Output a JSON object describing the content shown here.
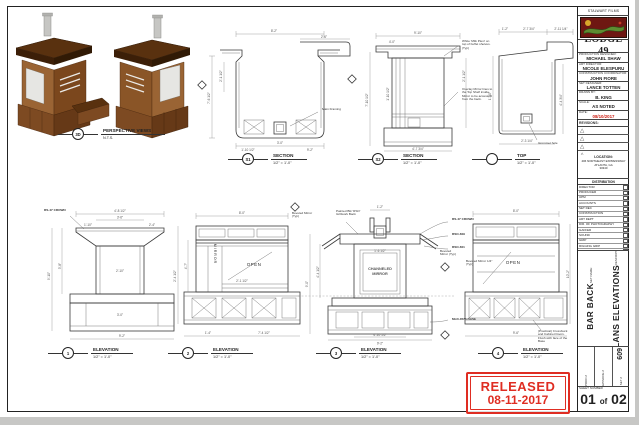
{
  "titleblock": {
    "studio": "STALWART FILMS",
    "show": "LODGE 49",
    "credits": [
      {
        "label": "PRODUCTION DESIGNER:",
        "value": "MICHAEL SHAW"
      },
      {
        "label": "ART DIRECTOR:",
        "value": "NICOLE ELESPURU"
      },
      {
        "label": "CONSTRUCTION COORDINATOR:",
        "value": "JOHN FIORE"
      },
      {
        "label": "SET DESIGNER:",
        "value": "LANCE TOTTEN"
      },
      {
        "label": "DRAWN BY:",
        "value": "B. KING"
      },
      {
        "label": "SCALE:",
        "value": "AS NOTED"
      },
      {
        "label": "DATE:",
        "value": "08/10/2017"
      }
    ],
    "revisions_label": "REVISIONS:",
    "location_label": "LOCATION:",
    "location_lines": [
      "406 NORTHEAST EXPRESSWAY",
      "ATLANTA, GA",
      "30340"
    ],
    "distribution_label": "DISTRIBUTION",
    "distribution": [
      "DIRECTOR",
      "PRODUCER",
      "UPM",
      "ACCOUNTS",
      "SET DEC",
      "CONSTRUCTION",
      "ART DEPT",
      "DIR. OF PHOTOGRAPHY",
      "GAFFER",
      "SOUND",
      "GRIP",
      "RIGGING GRIP",
      "SP. FX",
      "FILE",
      "LOCATIONS"
    ],
    "set_name_label": "SET NAME:",
    "set_name": "BAR BACK",
    "description_label": "DESCRIPTION:",
    "description": "PLANS ELEVATIONS",
    "prod_label": "PROD #",
    "episode_label": "EPISODE #",
    "set_no_label": "SET #",
    "set_no": "609",
    "sheet_number_label": "SHEET NUMBER",
    "sheet_number_left": "01",
    "sheet_number_of": "of",
    "sheet_number_right": "02"
  },
  "stamp": {
    "line1": "RELEASED",
    "line2": "08-11-2017"
  },
  "views": {
    "perspective": {
      "tag": "3D",
      "title": "PERSPECTIVE VIEWS",
      "scale": "N.T.S."
    },
    "section1": {
      "tag": "S1",
      "title": "SECTION",
      "scale": "1/2\" = 1'-0\"",
      "note": "Main Framing",
      "dims": [
        "8'-2\"",
        "2'-6\"",
        "2'-1 1/2\"",
        "7'-6 1/2\"",
        "3'-0\"",
        "1'-10 1/2\"",
        "9'-2\""
      ]
    },
    "section2": {
      "tag": "S2",
      "title": "SECTION",
      "scale": "1/2\" = 1'-0\"",
      "note1": "White 'Milk Plexi' on top of buffet shelves. (Typ)",
      "note2": "Overlay Mirror lines to the Top Shelf inside. Mirror to be accessed from the back.",
      "dims": [
        "9'-10\"",
        "4'-0\"",
        "2'-1 1/2\"",
        "7'-10 1/2\"",
        "1'-10 1/2\"",
        "4'-7 3/4\""
      ]
    },
    "top": {
      "tag": "",
      "title": "TOP",
      "scale": "1/2\" = 1'-0\"",
      "note": "Grommet hole",
      "dims": [
        "1'-2\"",
        "2'-7 3/4\"",
        "2'-11 1/4\"",
        "1'-10\"",
        "4'-4 3/4\"",
        "2'-3 1/4\""
      ]
    },
    "elev1": {
      "tag": "1",
      "title": "ELEVATION",
      "scale": "1/2\" = 1'-0\"",
      "callout": "RS-47 CROWN",
      "dims": [
        "4'-8 1/2\"",
        "3'-6\"",
        "1'-10\"",
        "2'-4\"",
        "9'-10\"",
        "3'-8\"",
        "2'-10\"",
        "3'-0\"",
        "9'-2\""
      ]
    },
    "elev2": {
      "tag": "2",
      "title": "ELEVATION",
      "scale": "1/2\" = 1'-0\"",
      "mirror_label": "MIRROR",
      "open_label": "OPEN",
      "note": "Beveled Mirror (Typ)",
      "dims": [
        "8'-0\"",
        "2'-4 1/2\"",
        "4'-7\"",
        "2'-1 1/2\"",
        "1'-4\"",
        "7'-4 1/2\""
      ]
    },
    "elev3": {
      "tag": "3",
      "title": "ELEVATION",
      "scale": "1/2\" = 1'-0\"",
      "center_label_1": "CHANNELED",
      "center_label_2": "MIRROR",
      "callout_crown": "RS-47 CROWN",
      "callout_rso1": "RSO-609",
      "callout_rso2": "RSO-601",
      "callout_base": "MLD-3573 BASE",
      "note_left": "Painted Blk 'RSO' Grillwork Back",
      "note_mirror": "Beveled Mirror 1/4\" (Typ)",
      "dims": [
        "1'-2\"",
        "9'-0\"",
        "4'-4 1/2\"",
        "1'-6 1/2\"",
        "4'-10 1/2\"",
        "9'-2\""
      ]
    },
    "elev4": {
      "tag": "4",
      "title": "ELEVATION",
      "scale": "1/2\" = 1'-0\"",
      "open_label": "OPEN",
      "note_left": "Beveled Mirror (Typ)",
      "note_bottom": "(Practical) Crossbuck and Cabinet Doors. Flush with face of the Base",
      "dims": [
        "8'-0\"",
        "10'-2\"",
        "9'-6\""
      ]
    }
  }
}
